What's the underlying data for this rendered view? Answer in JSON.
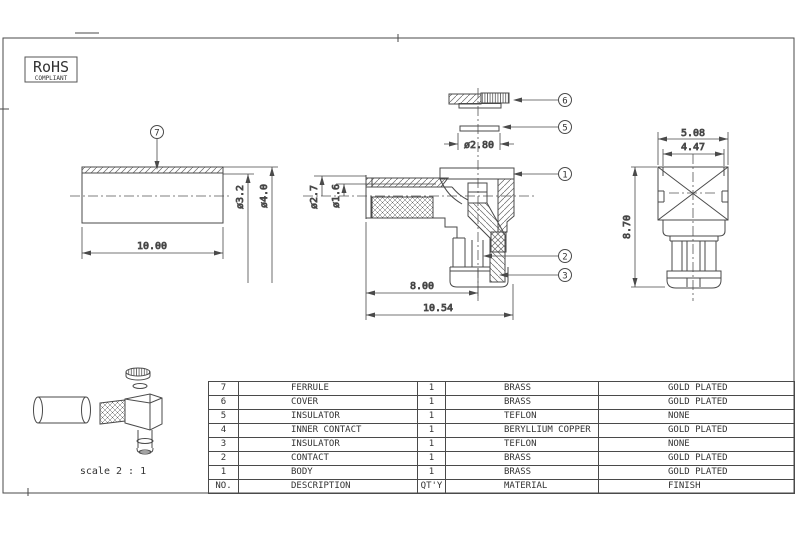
{
  "rohs": {
    "title": "RoHS",
    "subtitle": "COMPLIANT"
  },
  "scale_note": "scale 2 : 1",
  "callouts": {
    "c1": "1",
    "c2": "2",
    "c3": "3",
    "c5": "5",
    "c6": "6",
    "c7": "7"
  },
  "dims": {
    "ferrule_length": "10.00",
    "ferrule_inner_dia": "ø3.2",
    "ferrule_outer_dia": "ø4.0",
    "cable_entry_dia": "ø2.7",
    "pin_hole_dia": "ø1.6",
    "insulator_dia": "ø2.80",
    "port_offset": "8.00",
    "overall_length": "10.54",
    "body_width": "5.08",
    "body_flat_width": "4.47",
    "body_height": "8.70"
  },
  "table": {
    "header": {
      "no": "NO.",
      "description": "DESCRIPTION",
      "qty": "QT'Y",
      "material": "MATERIAL",
      "finish": "FINISH"
    },
    "rows": [
      {
        "no": "7",
        "description": "FERRULE",
        "qty": "1",
        "material": "BRASS",
        "finish": "GOLD PLATED"
      },
      {
        "no": "6",
        "description": "COVER",
        "qty": "1",
        "material": "BRASS",
        "finish": "GOLD PLATED"
      },
      {
        "no": "5",
        "description": "INSULATOR",
        "qty": "1",
        "material": "TEFLON",
        "finish": "NONE"
      },
      {
        "no": "4",
        "description": "INNER CONTACT",
        "qty": "1",
        "material": "BERYLLIUM COPPER",
        "finish": "GOLD PLATED"
      },
      {
        "no": "3",
        "description": "INSULATOR",
        "qty": "1",
        "material": "TEFLON",
        "finish": "NONE"
      },
      {
        "no": "2",
        "description": "CONTACT",
        "qty": "1",
        "material": "BRASS",
        "finish": "GOLD PLATED"
      },
      {
        "no": "1",
        "description": "BODY",
        "qty": "1",
        "material": "BRASS",
        "finish": "GOLD PLATED"
      }
    ]
  },
  "colors": {
    "line": "#4a4a4a",
    "hatch": "#666666",
    "text": "#333333",
    "background": "#ffffff"
  }
}
